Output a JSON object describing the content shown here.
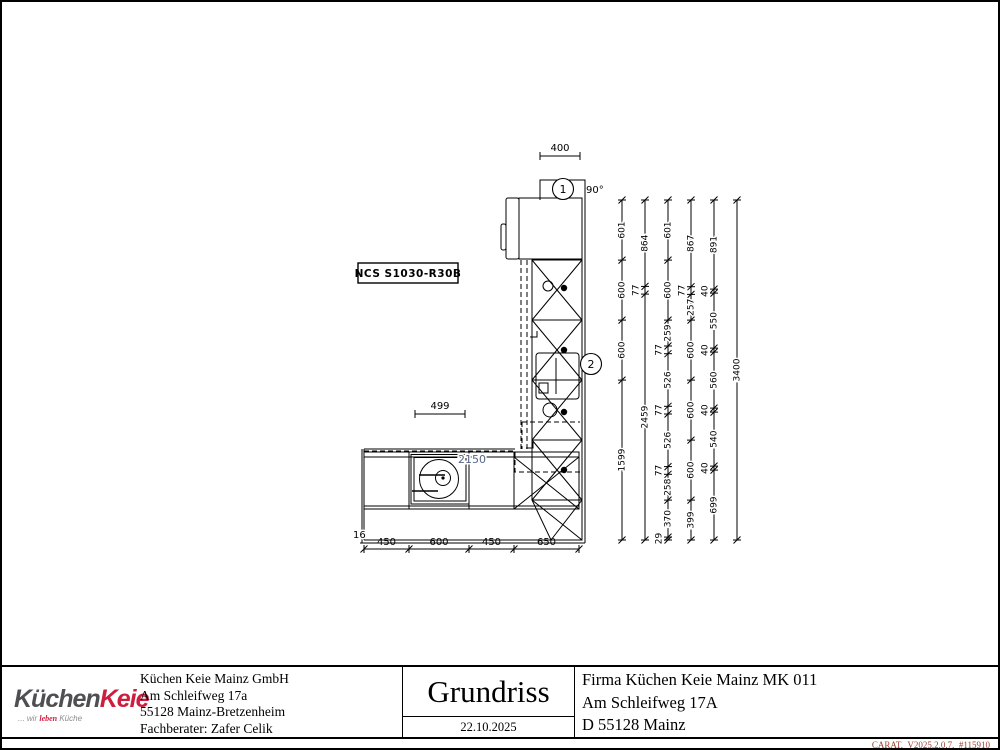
{
  "sheet": {
    "ncs_label": "NCS S1030-R30B",
    "angle_label": "90°",
    "marker_1": "1",
    "marker_2": "2",
    "dim_top": "400",
    "dim_hob": "499",
    "dim_run_total": "2150",
    "dim_wall_small": "16",
    "right_dimension_chains": [
      {
        "name": "chain-1",
        "values": [
          601,
          600,
          600,
          1599
        ]
      },
      {
        "name": "chain-2",
        "values": [
          864,
          77,
          2459
        ]
      },
      {
        "name": "chain-3",
        "values": [
          601,
          600,
          259,
          77,
          526,
          77,
          526,
          77,
          258,
          370,
          29
        ]
      },
      {
        "name": "chain-4",
        "values": [
          867,
          77,
          257,
          600,
          600,
          600,
          399
        ]
      },
      {
        "name": "chain-5",
        "values": [
          891,
          40,
          550,
          40,
          560,
          40,
          540,
          40,
          699
        ]
      },
      {
        "name": "chain-6",
        "values": [
          3400
        ]
      }
    ],
    "bottom_dimension_chain": [
      450,
      600,
      450,
      650
    ],
    "room_total_mm": 3400
  },
  "title_block": {
    "logo": {
      "part1": "Küchen",
      "part2": "Keie",
      "tagline_pre": "... wir ",
      "tagline_accent": "leben",
      "tagline_post": " Küche",
      "accent_color": "#cc1f3f"
    },
    "company": [
      "Küchen Keie Mainz GmbH",
      "Am Schleifweg 17a",
      "55128 Mainz-Bretzenheim",
      "Fachberater: Zafer Celik"
    ],
    "document_title": "Grundriss",
    "date": "22.10.2025",
    "customer": [
      "Firma Küchen Keie Mainz MK 011",
      "Am Schleifweg 17A",
      "D 55128 Mainz"
    ],
    "footer": "CARAT,  V2025.2.0.7,  #115910"
  }
}
